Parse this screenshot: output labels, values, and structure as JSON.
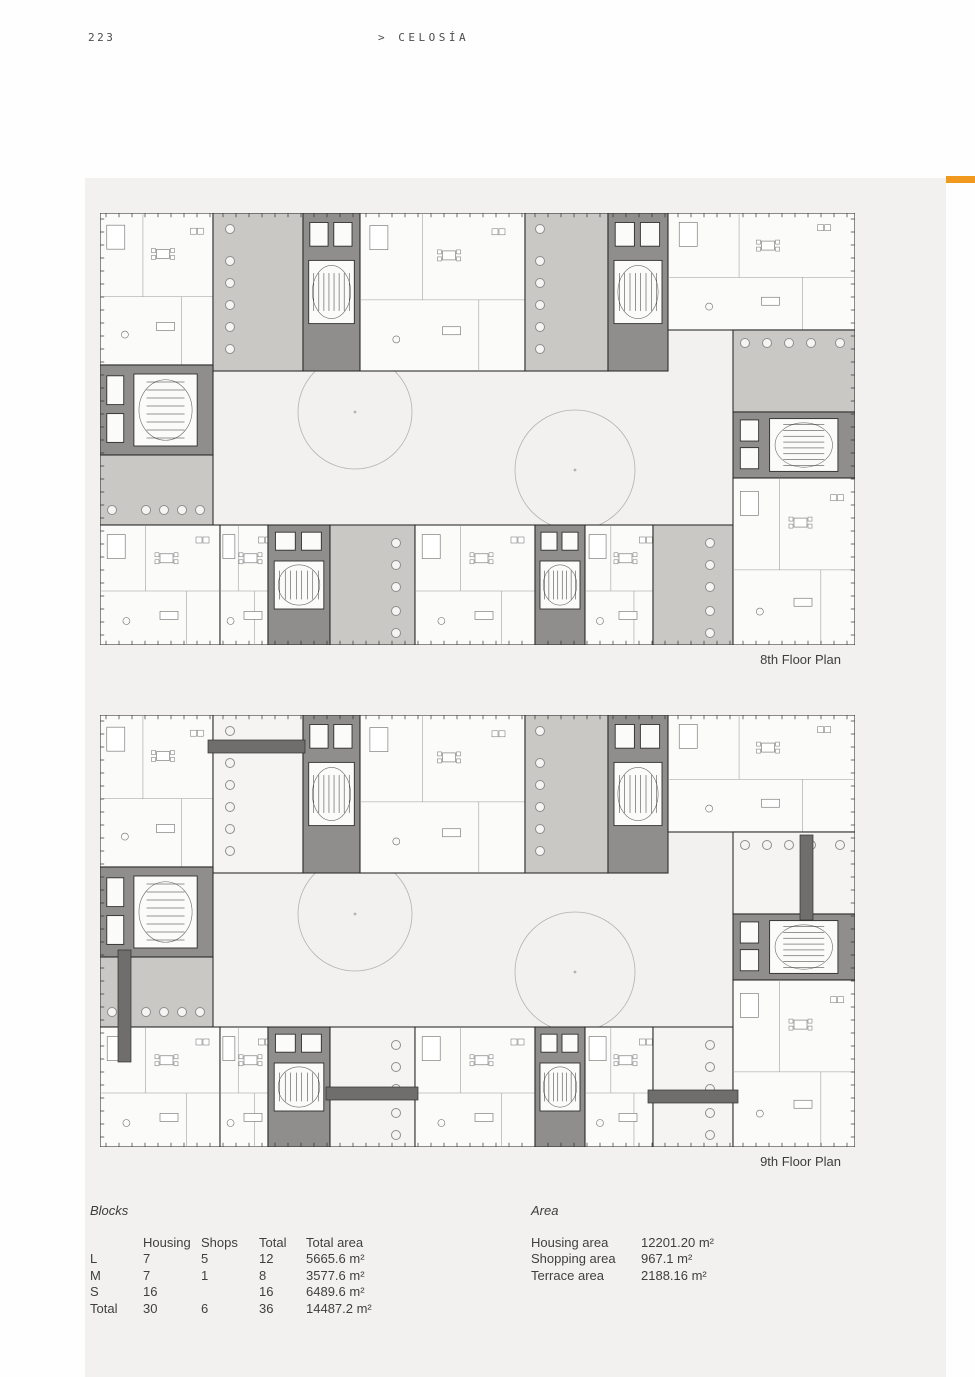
{
  "page": {
    "number": "223",
    "title": "> CELOSÍA"
  },
  "palette": {
    "accent_orange": "#F0991E",
    "panel_bg": "#f2f1ef",
    "apartment": "#fbfbfa",
    "terrace": "#c9c8c5",
    "terrace_open": "#f5f4f2",
    "core": "#8f8e8c",
    "wall": "#2f2f2e",
    "partition": "#9a9998",
    "furn": "#6b6b6a",
    "circle_stroke": "#b3b2b0",
    "circle_on_terrace": "#8f8e8c",
    "bridge": "#6f6e6c"
  },
  "plans": [
    {
      "label": "8th Floor Plan",
      "white_terraces": [],
      "bridges": []
    },
    {
      "label": "9th Floor Plan",
      "white_terraces": [
        "t1",
        "t4",
        "t5",
        "t6"
      ],
      "bridges": [
        [
          108,
          25,
          97,
          13
        ],
        [
          18,
          235,
          13,
          112
        ],
        [
          226,
          372,
          92,
          13
        ],
        [
          548,
          375,
          90,
          13
        ],
        [
          700,
          120,
          13,
          85
        ]
      ]
    }
  ],
  "floor_plan_geometry": {
    "viewbox": [
      755,
      432
    ],
    "courtyard_circles": [
      [
        255,
        199,
        57
      ],
      [
        475,
        257,
        60
      ]
    ],
    "blocks": [
      [
        "a1",
        0,
        0,
        113,
        152,
        "apartment"
      ],
      [
        "t1",
        113,
        0,
        90,
        158,
        "terrace"
      ],
      [
        "c1",
        203,
        0,
        57,
        158,
        "core"
      ],
      [
        "a2",
        260,
        0,
        165,
        158,
        "apartment"
      ],
      [
        "t2",
        425,
        0,
        83,
        158,
        "terrace"
      ],
      [
        "c2",
        508,
        0,
        60,
        158,
        "core"
      ],
      [
        "a3",
        568,
        0,
        187,
        117,
        "apartment"
      ],
      [
        "c3",
        0,
        152,
        113,
        90,
        "core"
      ],
      [
        "t3",
        0,
        242,
        113,
        70,
        "terrace"
      ],
      [
        "a5",
        0,
        312,
        120,
        120,
        "apartment"
      ],
      [
        "a6",
        120,
        312,
        48,
        120,
        "apartment"
      ],
      [
        "c4",
        168,
        312,
        62,
        120,
        "core"
      ],
      [
        "t4",
        230,
        312,
        85,
        120,
        "terrace"
      ],
      [
        "a7",
        315,
        312,
        120,
        120,
        "apartment"
      ],
      [
        "c5",
        435,
        312,
        50,
        120,
        "core"
      ],
      [
        "a8",
        485,
        312,
        68,
        120,
        "apartment"
      ],
      [
        "t5",
        553,
        312,
        80,
        120,
        "terrace"
      ],
      [
        "t6",
        633,
        117,
        122,
        82,
        "terrace"
      ],
      [
        "c6",
        633,
        199,
        122,
        66,
        "core"
      ],
      [
        "a9",
        633,
        265,
        122,
        167,
        "apartment"
      ]
    ],
    "terrace_circles": [
      [
        "t1",
        130,
        16
      ],
      [
        "t1",
        130,
        48
      ],
      [
        "t1",
        130,
        70
      ],
      [
        "t1",
        130,
        92
      ],
      [
        "t1",
        130,
        114
      ],
      [
        "t1",
        130,
        136
      ],
      [
        "t2",
        440,
        16
      ],
      [
        "t2",
        440,
        48
      ],
      [
        "t2",
        440,
        70
      ],
      [
        "t2",
        440,
        92
      ],
      [
        "t2",
        440,
        114
      ],
      [
        "t2",
        440,
        136
      ],
      [
        "t3",
        12,
        297
      ],
      [
        "t3",
        46,
        297
      ],
      [
        "t3",
        64,
        297
      ],
      [
        "t3",
        82,
        297
      ],
      [
        "t3",
        100,
        297
      ],
      [
        "t4",
        296,
        330
      ],
      [
        "t4",
        296,
        352
      ],
      [
        "t4",
        296,
        374
      ],
      [
        "t4",
        296,
        398
      ],
      [
        "t4",
        296,
        420
      ],
      [
        "t5",
        610,
        330
      ],
      [
        "t5",
        610,
        352
      ],
      [
        "t5",
        610,
        374
      ],
      [
        "t5",
        610,
        398
      ],
      [
        "t5",
        610,
        420
      ],
      [
        "t6",
        645,
        130
      ],
      [
        "t6",
        667,
        130
      ],
      [
        "t6",
        689,
        130
      ],
      [
        "t6",
        711,
        130
      ],
      [
        "t6",
        740,
        130
      ]
    ]
  },
  "blocks_table": {
    "title": "Blocks",
    "columns": [
      "",
      "Housing",
      "Shops",
      "Total",
      "Total area"
    ],
    "rows": [
      [
        "L",
        "7",
        "5",
        "12",
        "5665.6 m²"
      ],
      [
        "M",
        "7",
        "1",
        "8",
        "3577.6 m²"
      ],
      [
        "S",
        "16",
        "",
        "16",
        "6489.6 m²"
      ],
      [
        "Total",
        "30",
        "6",
        "36",
        "14487.2 m²"
      ]
    ]
  },
  "area_table": {
    "title": "Area",
    "rows": [
      [
        "Housing area",
        "12201.20 m²"
      ],
      [
        "Shopping area",
        "967.1 m²"
      ],
      [
        "Terrace area",
        "2188.16 m²"
      ]
    ]
  }
}
